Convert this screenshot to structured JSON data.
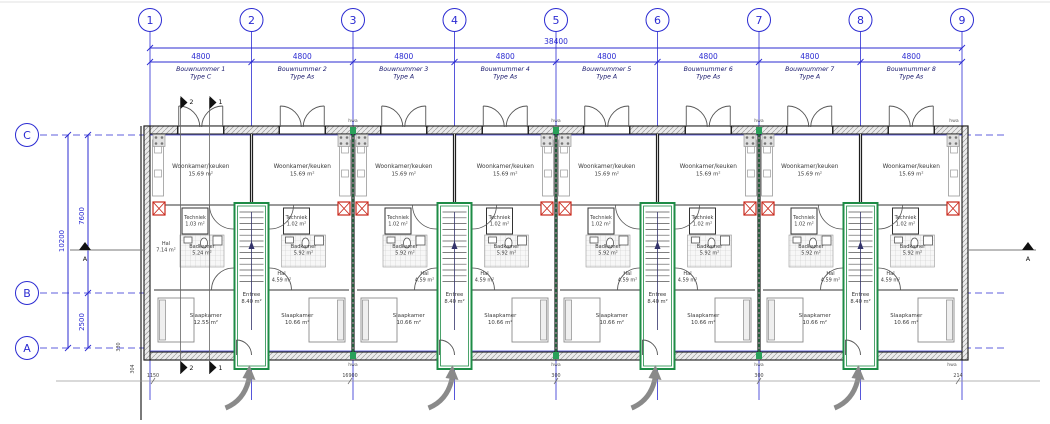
{
  "drawing": {
    "grid_columns": [
      "1",
      "2",
      "3",
      "4",
      "5",
      "6",
      "7",
      "8",
      "9"
    ],
    "grid_rows": [
      "C",
      "B",
      "A"
    ],
    "dims": {
      "total_width": "38400",
      "bay_width": "4800",
      "c_to_b": "7600",
      "b_to_a": "2500",
      "total_depth": "10200",
      "bottom": [
        "304",
        "1150",
        "330",
        "16900",
        "300",
        "300",
        "214"
      ]
    },
    "units": [
      {
        "bouwnummer": "Bouwnummer 1",
        "type": "Type C",
        "living": "Woonkamer/keuken",
        "living_area": "15.69 m²",
        "tech": "Techniek",
        "tech_area": "1.03 m²",
        "bath": "Badkamer",
        "bath_area": "5.24 m²",
        "hall": "Hal",
        "hall_area": "7.14 m²",
        "bed": "Slaapkamer",
        "bed_area": "12.55 m²"
      },
      {
        "bouwnummer": "Bouwnummer 2",
        "type": "Type As",
        "living": "Woonkamer/keuken",
        "living_area": "15.69 m²",
        "tech": "Techniek",
        "tech_area": "1.02 m²",
        "bath": "Badkamer",
        "bath_area": "5.92 m²",
        "hall": "Hal",
        "hall_area": "4.59 m²",
        "bed": "Slaapkamer",
        "bed_area": "10.66 m²"
      },
      {
        "bouwnummer": "Bouwnummer 3",
        "type": "Type A",
        "living": "Woonkamer/keuken",
        "living_area": "15.69 m²",
        "tech": "Techniek",
        "tech_area": "1.02 m²",
        "bath": "Badkamer",
        "bath_area": "5.92 m²",
        "hall": "Hal",
        "hall_area": "4.59 m²",
        "bed": "Slaapkamer",
        "bed_area": "10.66 m²"
      },
      {
        "bouwnummer": "Bouwnummer 4",
        "type": "Type As",
        "living": "Woonkamer/keuken",
        "living_area": "15.69 m²",
        "tech": "Techniek",
        "tech_area": "1.02 m²",
        "bath": "Badkamer",
        "bath_area": "5.92 m²",
        "hall": "Hal",
        "hall_area": "4.59 m²",
        "bed": "Slaapkamer",
        "bed_area": "10.66 m²"
      },
      {
        "bouwnummer": "Bouwnummer 5",
        "type": "Type A",
        "living": "Woonkamer/keuken",
        "living_area": "15.69 m²",
        "tech": "Techniek",
        "tech_area": "1.02 m²",
        "bath": "Badkamer",
        "bath_area": "5.92 m²",
        "hall": "Hal",
        "hall_area": "4.59 m²",
        "bed": "Slaapkamer",
        "bed_area": "10.66 m²"
      },
      {
        "bouwnummer": "Bouwnummer 6",
        "type": "Type As",
        "living": "Woonkamer/keuken",
        "living_area": "15.69 m²",
        "tech": "Techniek",
        "tech_area": "1.02 m²",
        "bath": "Badkamer",
        "bath_area": "5.92 m²",
        "hall": "Hal",
        "hall_area": "4.59 m²",
        "bed": "Slaapkamer",
        "bed_area": "10.66 m²"
      },
      {
        "bouwnummer": "Bouwnummer 7",
        "type": "Type A",
        "living": "Woonkamer/keuken",
        "living_area": "15.69 m²",
        "tech": "Techniek",
        "tech_area": "1.02 m²",
        "bath": "Badkamer",
        "bath_area": "5.92 m²",
        "hall": "Hal",
        "hall_area": "4.59 m²",
        "bed": "Slaapkamer",
        "bed_area": "10.66 m²"
      },
      {
        "bouwnummer": "Bouwnummer 8",
        "type": "Type As",
        "living": "Woonkamer/keuken",
        "living_area": "15.69 m²",
        "tech": "Techniek",
        "tech_area": "1.02 m²",
        "bath": "Badkamer",
        "bath_area": "5.92 m²",
        "hall": "Hal",
        "hall_area": "4.59 m²",
        "bed": "Slaapkamer",
        "bed_area": "10.66 m²"
      }
    ],
    "core": {
      "name": "Entree",
      "area": "8.40 m²",
      "count": 4
    },
    "sections": {
      "horizontal": "A",
      "vertical_1": "1",
      "vertical_2": "2"
    },
    "annotations": {
      "hwa": "hwa"
    },
    "colors": {
      "grid_blue": "#2b2bd2",
      "label_blue": "#16166b",
      "wall": "#1a1a1a",
      "green": "#1e8c46",
      "red": "#c9281c",
      "gray": "#8a8a8a"
    }
  }
}
